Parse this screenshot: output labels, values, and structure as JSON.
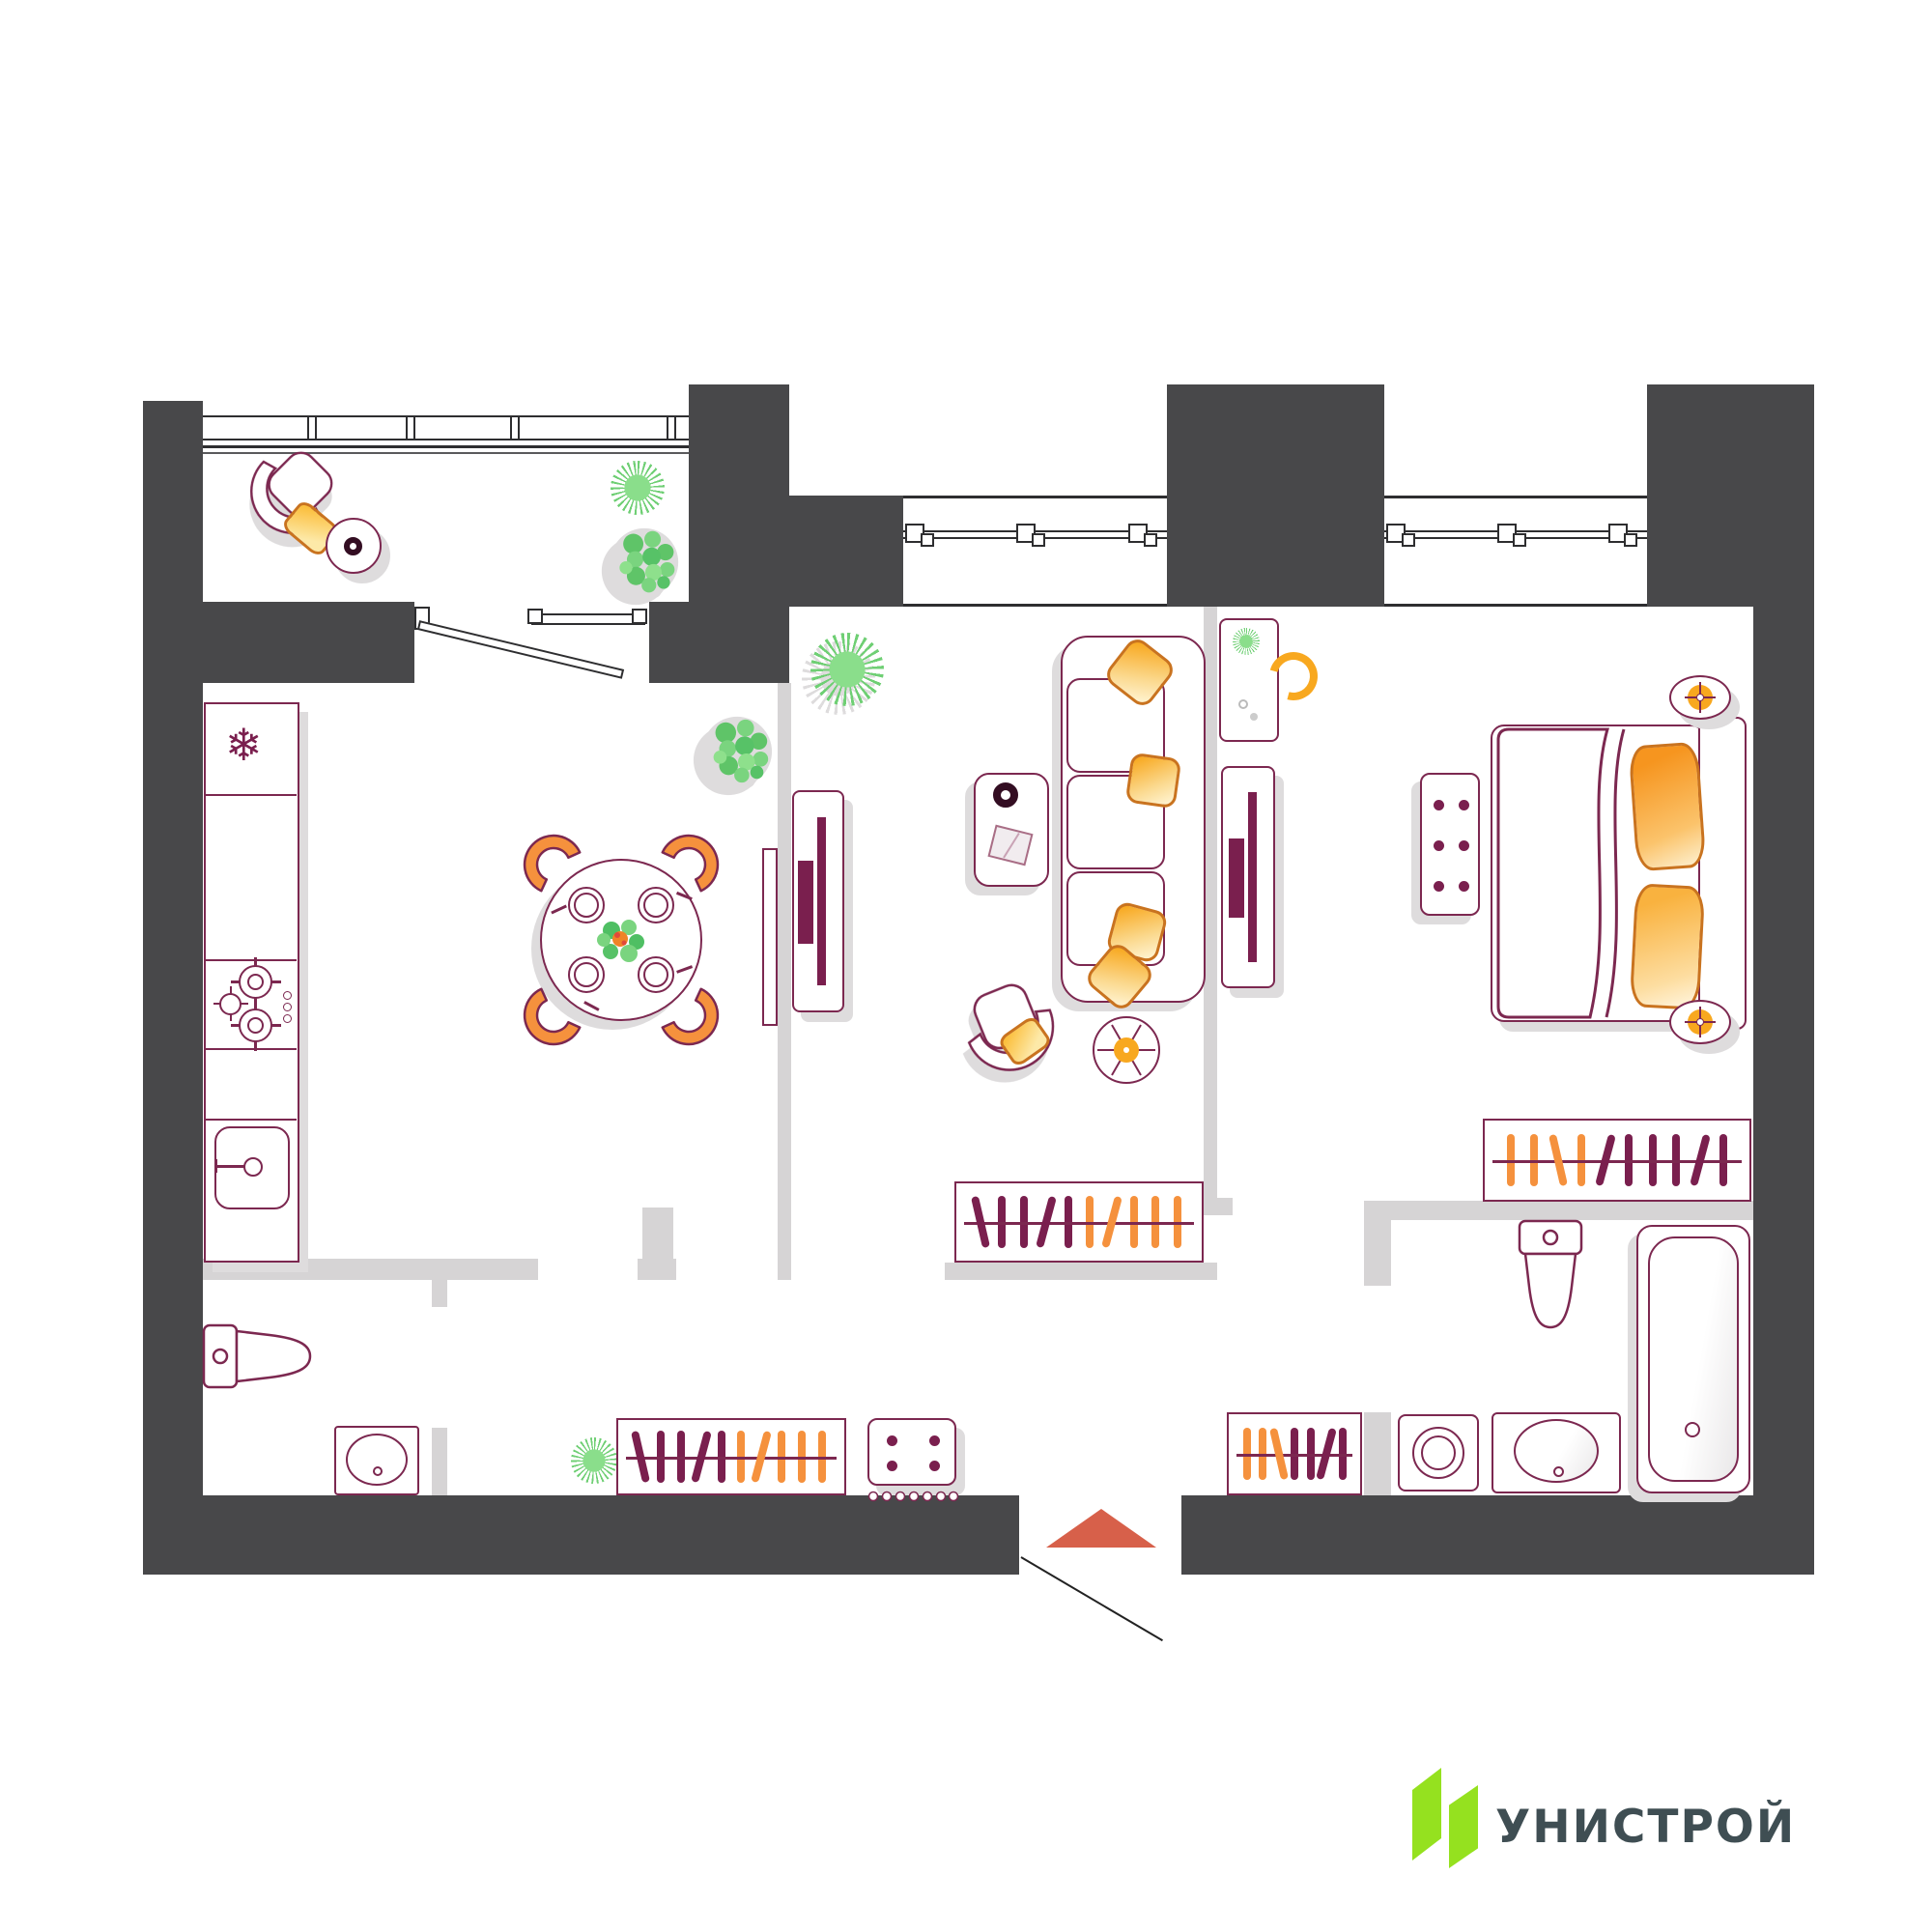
{
  "logo": {
    "text": "УНИСТРОЙ"
  },
  "colors": {
    "wall": "#48484a",
    "partition": "#d6d4d5",
    "outline": "#7c2850",
    "plum": "#7a1f4e",
    "orange": "#f5913d",
    "orangeBright": "#f8a81f",
    "pillowEdge": "#c9731f",
    "yellow": "#fbbf3e",
    "green": "#6fcf74",
    "greenLight": "#8ade8b",
    "entrance": "#d7604a",
    "shadow": "#dedcdd",
    "windowLine": "#2e2e30",
    "logoGreen": "#95e11f",
    "logoText": "#3f4e53",
    "cupDark": "#330d22"
  },
  "floorplan": {
    "type": "apartment-2-room",
    "rooms": [
      {
        "id": "balcony",
        "items": [
          "armchair",
          "yellow-pillow",
          "round-side-table",
          "cup",
          "spiky-plant",
          "bush-plant"
        ]
      },
      {
        "id": "kitchen",
        "items": [
          "fridge",
          "counter",
          "stove-4-burners",
          "sink-with-faucet"
        ]
      },
      {
        "id": "dining",
        "items": [
          "round-table",
          "4-plates",
          "4-orange-chairs",
          "green-centerpiece",
          "bush-plant",
          "wall-console"
        ]
      },
      {
        "id": "living",
        "items": [
          "sofa-3-seat",
          "4-pillows",
          "coffee-table",
          "cup",
          "book",
          "armchair",
          "round-side-table",
          "tv-console",
          "tv",
          "wardrobe",
          "spiky-plant"
        ]
      },
      {
        "id": "bedroom",
        "items": [
          "double-bed",
          "2-orange-pillows",
          "blanket",
          "headboard",
          "2-nightstand-lamps",
          "button-bench",
          "desk",
          "desk-chair",
          "desk-plant",
          "tv-console",
          "tv",
          "wardrobe"
        ]
      },
      {
        "id": "bathroom-small",
        "items": [
          "toilet",
          "washbasin"
        ]
      },
      {
        "id": "bathroom-main",
        "items": [
          "toilet",
          "bathtub",
          "washing-machine",
          "washbasin"
        ]
      },
      {
        "id": "hallway",
        "items": [
          "wardrobe",
          "wardrobe",
          "shoe-cabinet",
          "shoe-tray",
          "plant",
          "entrance-arrow",
          "door-swing"
        ]
      }
    ],
    "windows": {
      "count": 2,
      "handles_per_window": 3,
      "balcony_glazing_panels": 4
    },
    "entrance_marker": "triangle-up"
  },
  "wardrobes": {
    "living": [
      "plum-slant2",
      "plum",
      "plum",
      "plum-slant",
      "plum",
      "orange",
      "orange-slant",
      "orange",
      "orange",
      "orange"
    ],
    "bedroom": [
      "orange",
      "orange",
      "orange-slant2",
      "orange",
      "plum-slant",
      "plum",
      "plum",
      "plum",
      "plum-slant",
      "plum"
    ],
    "hall1": [
      "plum-slant2",
      "plum",
      "plum",
      "plum-slant",
      "plum",
      "orange",
      "orange-slant",
      "orange",
      "orange",
      "orange"
    ],
    "hall2": [
      "orange",
      "orange",
      "orange-slant2",
      "plum",
      "plum",
      "plum-slant",
      "plum"
    ]
  }
}
